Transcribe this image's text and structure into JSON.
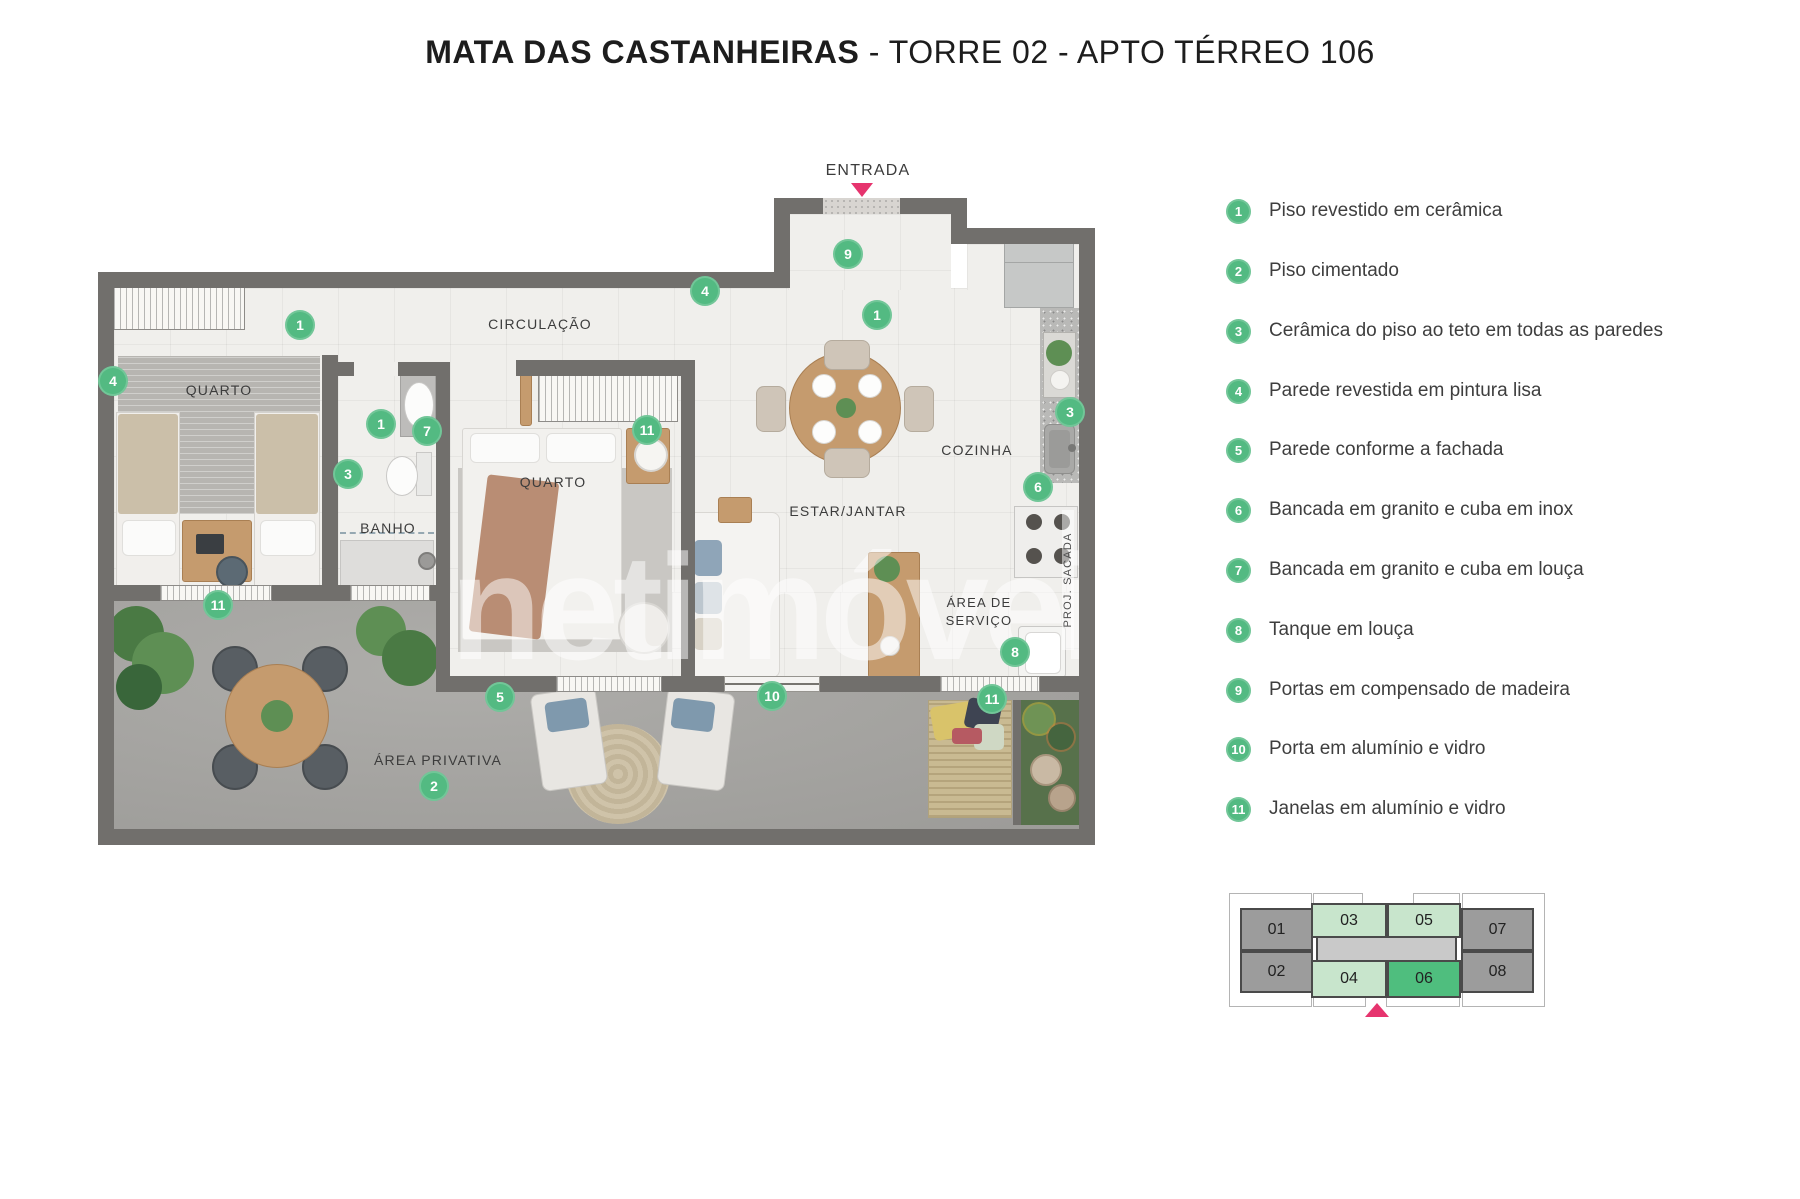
{
  "title": {
    "project": "MATA DAS CASTANHEIRAS",
    "rest": " - TORRE 02 - APTO TÉRREO 106"
  },
  "plan": {
    "entrance_label": "ENTRADA",
    "room_labels": {
      "bedroom1": "QUARTO",
      "bathroom": "BANHO",
      "circulation": "CIRCULAÇÃO",
      "bedroom2": "QUARTO",
      "living": "ESTAR/JANTAR",
      "kitchen": "COZINHA",
      "service_line1": "ÁREA DE",
      "service_line2": "SERVIÇO",
      "private_area": "ÁREA PRIVATIVA",
      "balcony_projection": "PROJ. SACADA"
    },
    "markers": [
      {
        "n": "9"
      },
      {
        "n": "4"
      },
      {
        "n": "1"
      },
      {
        "n": "1"
      },
      {
        "n": "4"
      },
      {
        "n": "3"
      },
      {
        "n": "1"
      },
      {
        "n": "7"
      },
      {
        "n": "11"
      },
      {
        "n": "3"
      },
      {
        "n": "6"
      },
      {
        "n": "8"
      },
      {
        "n": "11"
      },
      {
        "n": "5"
      },
      {
        "n": "10"
      },
      {
        "n": "11"
      },
      {
        "n": "2"
      }
    ]
  },
  "watermark": "netimóveis",
  "legend": {
    "items": [
      {
        "num": "1",
        "label": "Piso revestido em cerâmica"
      },
      {
        "num": "2",
        "label": "Piso cimentado"
      },
      {
        "num": "3",
        "label": "Cerâmica do piso ao teto em todas as paredes"
      },
      {
        "num": "4",
        "label": "Parede revestida em pintura lisa"
      },
      {
        "num": "5",
        "label": "Parede conforme a fachada"
      },
      {
        "num": "6",
        "label": "Bancada em granito e cuba em inox"
      },
      {
        "num": "7",
        "label": "Bancada em granito e cuba em louça"
      },
      {
        "num": "8",
        "label": "Tanque em louça"
      },
      {
        "num": "9",
        "label": "Portas em compensado de madeira"
      },
      {
        "num": "10",
        "label": "Porta em alumínio e vidro"
      },
      {
        "num": "11",
        "label": "Janelas em alumínio e vidro"
      }
    ]
  },
  "keyplan": {
    "units": [
      {
        "id": "01"
      },
      {
        "id": "02"
      },
      {
        "id": "03"
      },
      {
        "id": "04"
      },
      {
        "id": "05"
      },
      {
        "id": "06"
      },
      {
        "id": "07"
      },
      {
        "id": "08"
      }
    ],
    "highlighted_unit": "06"
  },
  "colors": {
    "marker_green": "#53ba82",
    "entrance_pink": "#e6346e",
    "wall_gray": "#716f6c",
    "keyplan_unit_green": "#4fbe7e",
    "keyplan_light_green": "#c8e5cc",
    "keyplan_gray": "#9c9c9c"
  }
}
